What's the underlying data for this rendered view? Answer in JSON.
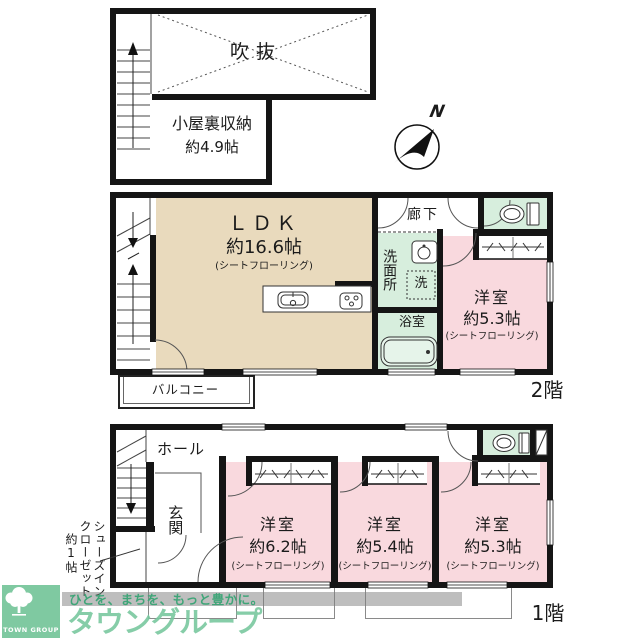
{
  "plan": {
    "attic": {
      "void": "吹抜",
      "storage_name": "小屋裏収納",
      "storage_size": "約4.9帖"
    },
    "compass_n": "N",
    "floor2": {
      "label": "2階",
      "ldk_name": "ＬＤＫ",
      "ldk_size": "約16.6帖",
      "ldk_flooring": "(シートフローリング)",
      "hallway": "廊下",
      "washroom": "洗面所",
      "washer": "洗",
      "bathroom": "浴室",
      "bedroom_name": "洋室",
      "bedroom_size": "約5.3帖",
      "bedroom_flooring": "(シートフローリング)",
      "balcony": "バルコニー"
    },
    "floor1": {
      "label": "1階",
      "hall": "ホール",
      "entrance": "玄関",
      "shoe_closet": "シューズイン\nクローゼット\n　約1帖",
      "bedroom1_name": "洋室",
      "bedroom1_size": "約6.2帖",
      "bedroom1_flooring": "(シートフローリング)",
      "bedroom2_name": "洋室",
      "bedroom2_size": "約5.4帖",
      "bedroom2_flooring": "(シートフローリング)",
      "bedroom3_name": "洋室",
      "bedroom3_size": "約5.3帖",
      "bedroom3_flooring": "(シートフローリング)"
    }
  },
  "branding": {
    "logo_text": "TOWN GROUP",
    "company": "タウングループ",
    "tagline": "ひとを、まちを、もっと豊かに。"
  },
  "colors": {
    "wall": "#151515",
    "ldk": "#e9dabd",
    "bedroom": "#f9d9de",
    "wet_area": "#d7eedd",
    "brand_green": "#7fc9a1",
    "tagline_green": "#3fa578"
  }
}
